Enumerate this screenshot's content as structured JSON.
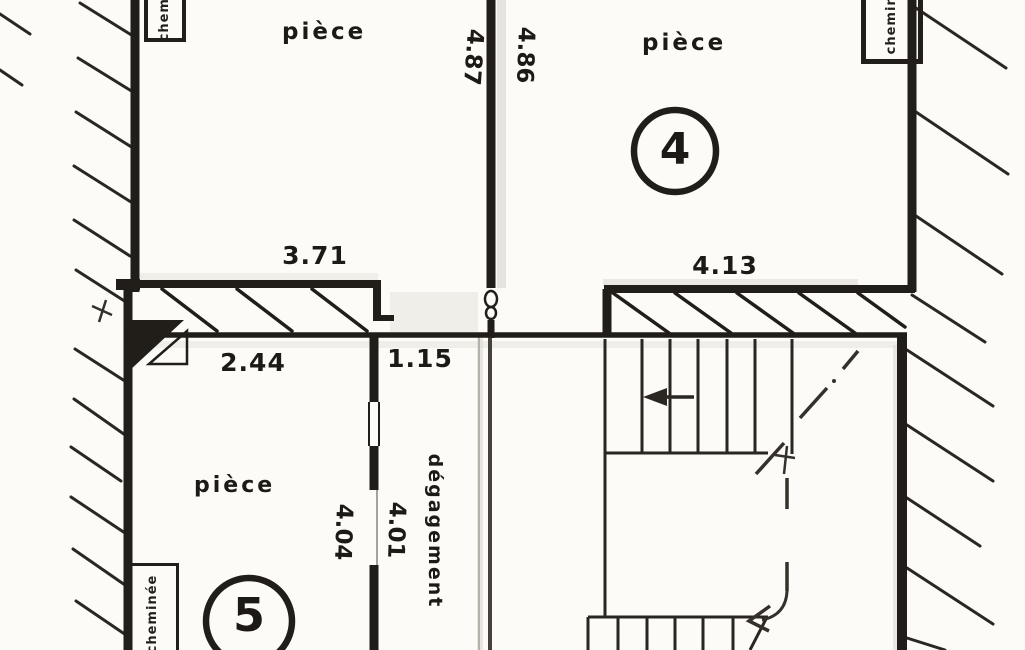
{
  "plan": {
    "rooms": [
      {
        "label": "pièce"
      },
      {
        "label": "pièce",
        "number": "4"
      },
      {
        "label": "pièce",
        "number": "5"
      },
      {
        "label": "dégagement"
      }
    ],
    "dimensions": {
      "room1_width": "3.71",
      "room4_width": "4.13",
      "room5_width": "2.44",
      "corridor_width": "1.15",
      "room1_depth": "4.87",
      "room4_depth": "4.86",
      "room5_depth": "4.04",
      "corridor_depth": "4.01"
    },
    "chimney_label": "cheminée",
    "colors": {
      "ink": "#211d18",
      "paper": "#fcfbf8"
    }
  }
}
